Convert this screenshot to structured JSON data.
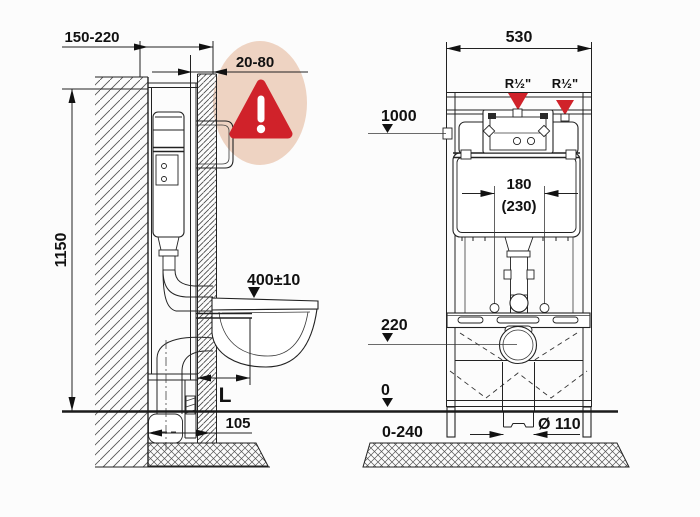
{
  "drawing": {
    "type": "wc-concealed-cistern-frame-installation-diagram",
    "side_view": {
      "depth_range": "150-220",
      "panel_thickness_range": "20-80",
      "frame_height": "1150",
      "bowl_height": "400±10",
      "projection": "L",
      "foot_offset": "105"
    },
    "front_view": {
      "frame_width": "530",
      "left_connection": "R½\"",
      "right_connection": "R½\"",
      "level_top": "1000",
      "rod_spacing": "180",
      "rod_spacing_alt": "(230)",
      "level_outlet": "220",
      "level_floor": "0",
      "feet_adjust_range": "0-240",
      "drain_diameter": "Ø 110"
    },
    "colors": {
      "highlight_bubble": "#eed3c2",
      "warning_red": "#d0222a",
      "line": "#222222"
    }
  }
}
